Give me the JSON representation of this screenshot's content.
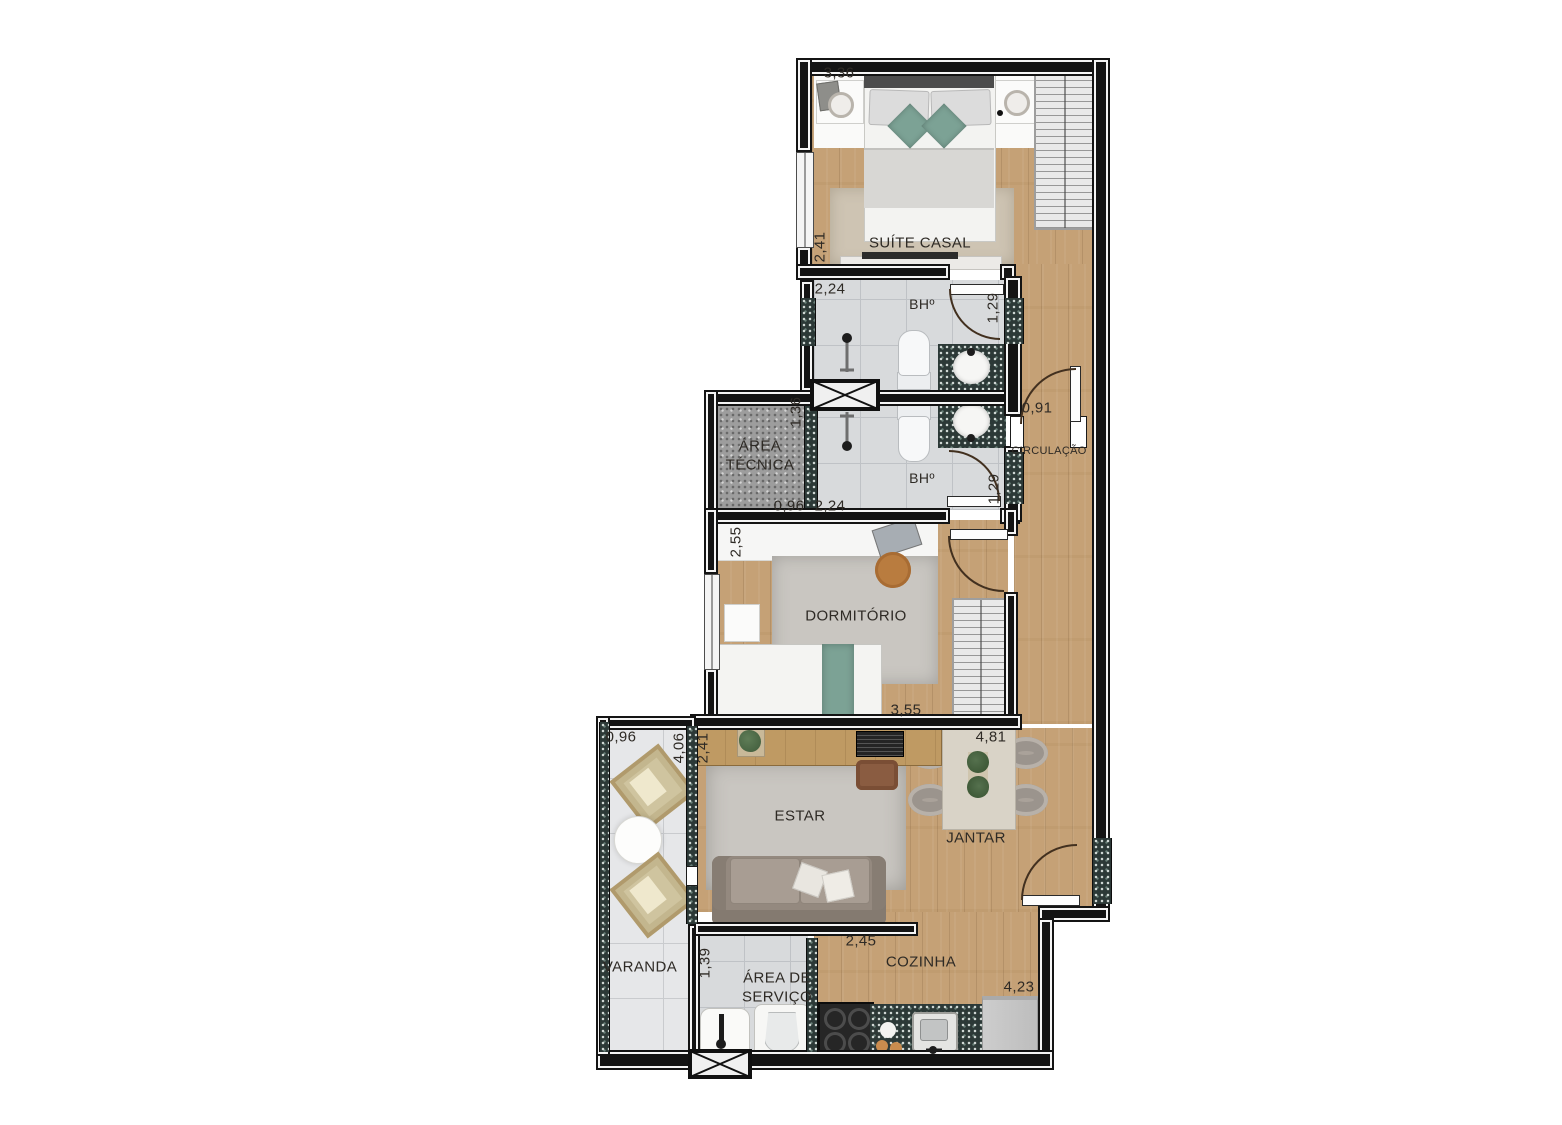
{
  "plan": {
    "rooms": {
      "suite": "SUÍTE CASAL",
      "bathroom1": "BHº",
      "bathroom2": "BHº",
      "area_tecnica": "ÁREA TÉCNICA",
      "circulacao": "CIRCULAÇÃO",
      "dormitorio": "DORMITÓRIO",
      "estar": "ESTAR",
      "jantar": "JANTAR",
      "varanda": "VARANDA",
      "area_servico": "ÁREA DE SERVIÇO",
      "cozinha": "COZINHA"
    },
    "dimensions": {
      "suite_width": "3,36",
      "suite_depth": "2,41",
      "bh1_width": "2,24",
      "bh1_depth": "1,29",
      "circ_door_width": "0,91",
      "area_tecnica_depth": "1,36",
      "area_tecnica_width": "0,96",
      "bh2_width": "2,24",
      "bh2_depth": "1,29",
      "dormitorio_depth": "2,55",
      "dormitorio_width": "3,55",
      "jantar_width": "4,81",
      "varanda_width": "0,96",
      "varanda_depth": "4,06",
      "estar_depth": "2,41",
      "estar_width": "2,45",
      "servico_depth": "1,39",
      "cozinha_width": "4,23"
    },
    "colors": {
      "wood": "#c5a176",
      "tile": "#d8dadc",
      "tile_varanda": "#e6e7e9",
      "granite": "#2c3937",
      "teal": "#7ca295",
      "rug_beige": "#cec4b3",
      "rug_gray": "#c9c6c1",
      "sofa": "#94897f",
      "wall": "#141414"
    }
  }
}
